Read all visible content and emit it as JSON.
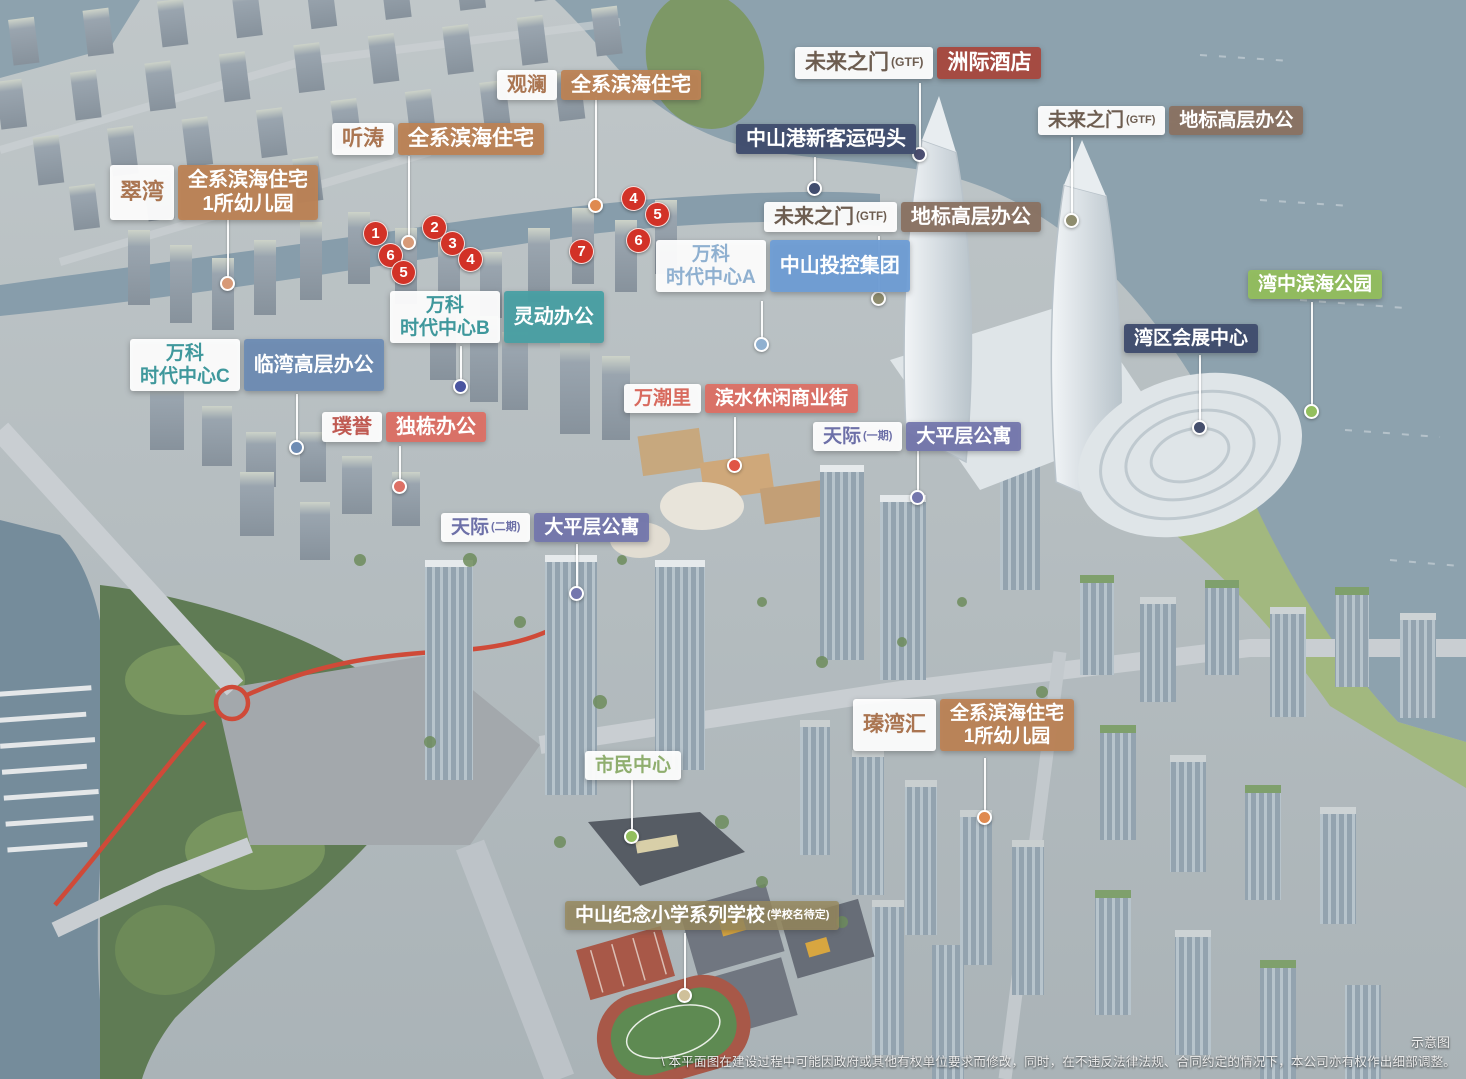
{
  "labels": {
    "cuiwan": {
      "name": "翠湾",
      "desc_line1": "全系滨海住宅",
      "desc_line2": "1所幼儿园"
    },
    "tingtao": {
      "name": "听涛",
      "desc": "全系滨海住宅"
    },
    "guanlan": {
      "name": "观澜",
      "desc": "全系滨海住宅"
    },
    "gtf_hotel": {
      "name": "未来之门",
      "tag": "(GTF)",
      "desc": "洲际酒店"
    },
    "port": {
      "desc": "中山港新客运码头"
    },
    "gtf_right": {
      "name": "未来之门",
      "tag": "(GTF)",
      "desc": "地标高层办公"
    },
    "gtf_mid": {
      "name": "未来之门",
      "tag": "(GTF)",
      "desc": "地标高层办公"
    },
    "bay_park": {
      "desc": "湾中滨海公园"
    },
    "expo": {
      "desc": "湾区会展中心"
    },
    "vanke_a": {
      "name_line1": "万科",
      "name_line2": "时代中心A",
      "desc": "中山投控集团"
    },
    "vanke_b": {
      "name_line1": "万科",
      "name_line2": "时代中心B",
      "desc": "灵动办公"
    },
    "vanke_c": {
      "name_line1": "万科",
      "name_line2": "时代中心C",
      "desc": "临湾高层办公"
    },
    "puyu": {
      "name": "璞誉",
      "desc": "独栋办公"
    },
    "wanchaoli": {
      "name": "万潮里",
      "desc": "滨水休闲商业街"
    },
    "tianji1": {
      "name": "天际",
      "tag": "(一期)",
      "desc": "大平层公寓"
    },
    "tianji2": {
      "name": "天际",
      "tag": "(二期)",
      "desc": "大平层公寓"
    },
    "civic": {
      "desc": "市民中心"
    },
    "zhenwanhui": {
      "name": "瑧湾汇",
      "desc_line1": "全系滨海住宅",
      "desc_line2": "1所幼儿园"
    },
    "school": {
      "desc": "中山纪念小学系列学校",
      "tag": "(学校名待定)"
    }
  },
  "badges": [
    "1",
    "6",
    "5",
    "2",
    "3",
    "4",
    "7",
    "4",
    "5",
    "6"
  ],
  "footer": {
    "note": "示意图",
    "disclaimer": "\\ 本平面图在建设过程中可能因政府或其他有权单位要求而修改，同时，在不违反法律法规、合同约定的情况下，本公司亦有权作出细部调整。"
  },
  "colors": {
    "residential_orange": "#bd8355",
    "hotel_brick_red": "#a8493f",
    "infrastructure_navy": "#414d6e",
    "office_brown": "#8a7263",
    "park_green": "#93bf5e",
    "office_teal": "#49a0a4",
    "group_blue": "#6f9ed6",
    "office_slate_blue": "#6e8cb4",
    "commercial_salmon": "#dd7065",
    "apartment_purple": "#7477ad",
    "civic_green_text": "#8fae6e",
    "school_khaki": "#988a5e",
    "badge_red": "#d23227"
  }
}
